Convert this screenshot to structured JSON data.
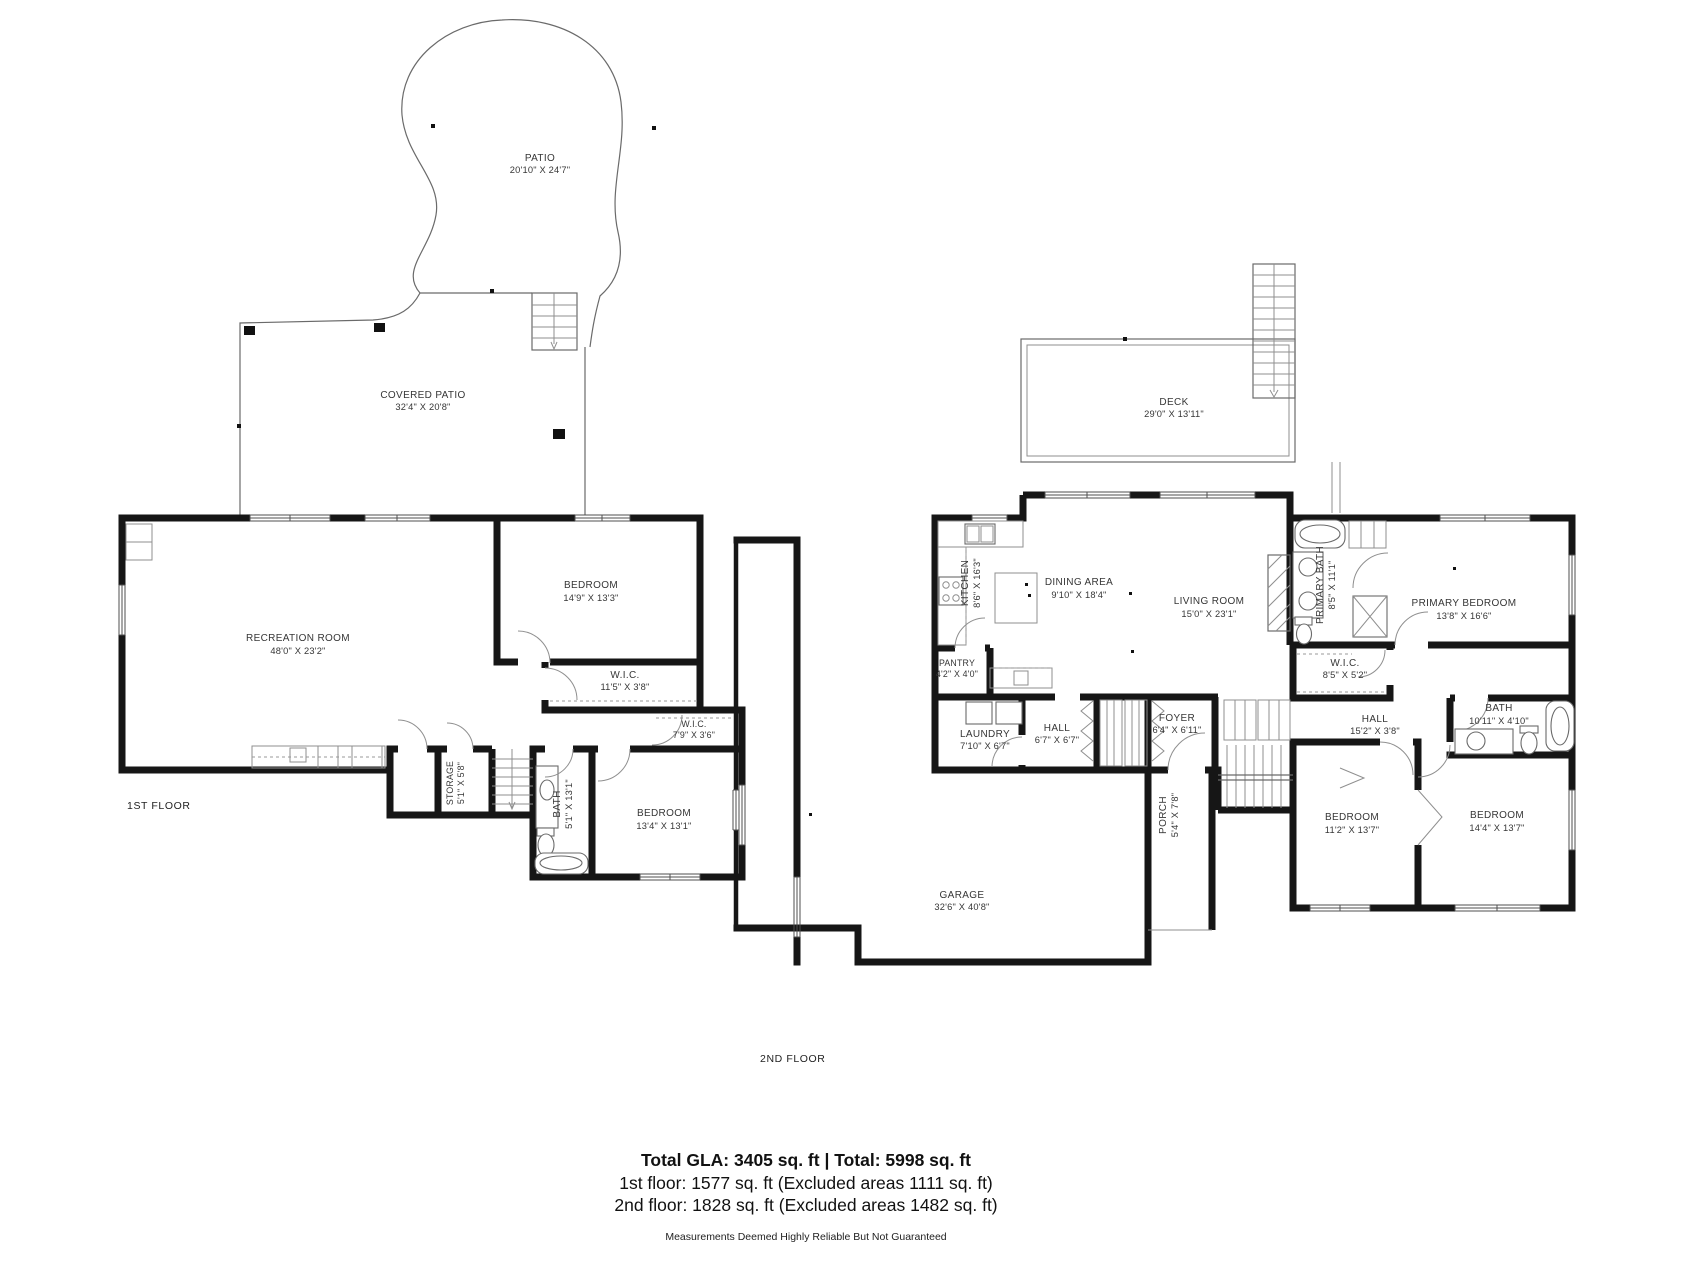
{
  "floors": {
    "f1": {
      "floor_label": "1ST FLOOR",
      "rooms": {
        "patio": {
          "name": "PATIO",
          "dims": "20'10\" X 24'7\""
        },
        "covered_patio": {
          "name": "COVERED PATIO",
          "dims": "32'4\" X 20'8\""
        },
        "recreation": {
          "name": "RECREATION ROOM",
          "dims": "48'0\" X 23'2\""
        },
        "bedroom_a": {
          "name": "BEDROOM",
          "dims": "14'9\" X 13'3\""
        },
        "wic_a": {
          "name": "W.I.C.",
          "dims": "11'5\" X 3'8\""
        },
        "wic_b": {
          "name": "W.I.C.",
          "dims": "7'9\" X 3'6\""
        },
        "storage": {
          "name": "STORAGE",
          "dims": "5'1\" X 5'8\""
        },
        "bath": {
          "name": "BATH",
          "dims": "5'1\" X 13'1\""
        },
        "bedroom_b": {
          "name": "BEDROOM",
          "dims": "13'4\" X 13'1\""
        }
      }
    },
    "f2": {
      "floor_label": "2ND FLOOR",
      "rooms": {
        "deck": {
          "name": "DECK",
          "dims": "29'0\" X 13'11\""
        },
        "kitchen": {
          "name": "KITCHEN",
          "dims": "8'6\" X 16'3\""
        },
        "dining": {
          "name": "DINING AREA",
          "dims": "9'10\" X 18'4\""
        },
        "living": {
          "name": "LIVING ROOM",
          "dims": "15'0\" X 23'1\""
        },
        "primary_bath": {
          "name": "PRIMARY BATH",
          "dims": "8'5\" X 11'1\""
        },
        "primary_bedroom": {
          "name": "PRIMARY BEDROOM",
          "dims": "13'8\" X 16'6\""
        },
        "wic": {
          "name": "W.I.C.",
          "dims": "8'5\" X 5'2\""
        },
        "pantry": {
          "name": "PANTRY",
          "dims": "4'2\" X 4'0\""
        },
        "laundry": {
          "name": "LAUNDRY",
          "dims": "7'10\" X 6'7\""
        },
        "hall_a": {
          "name": "HALL",
          "dims": "6'7\" X 6'7\""
        },
        "foyer": {
          "name": "FOYER",
          "dims": "6'4\" X 6'11\""
        },
        "hall_b": {
          "name": "HALL",
          "dims": "15'2\" X 3'8\""
        },
        "bath": {
          "name": "BATH",
          "dims": "10'11\" X 4'10\""
        },
        "porch": {
          "name": "PORCH",
          "dims": "5'4\" X 7'8\""
        },
        "garage": {
          "name": "GARAGE",
          "dims": "32'6\" X 40'8\""
        },
        "bedroom_a": {
          "name": "BEDROOM",
          "dims": "11'2\" X 13'7\""
        },
        "bedroom_b": {
          "name": "BEDROOM",
          "dims": "14'4\" X 13'7\""
        }
      }
    }
  },
  "footer": {
    "totals": "Total GLA: 3405 sq. ft | Total: 5998 sq. ft",
    "first_floor": "1st floor: 1577 sq. ft (Excluded areas 1111 sq. ft)",
    "second_floor": "2nd floor: 1828 sq. ft (Excluded areas 1482 sq. ft)",
    "disclaimer": "Measurements Deemed Highly Reliable But Not Guaranteed"
  }
}
